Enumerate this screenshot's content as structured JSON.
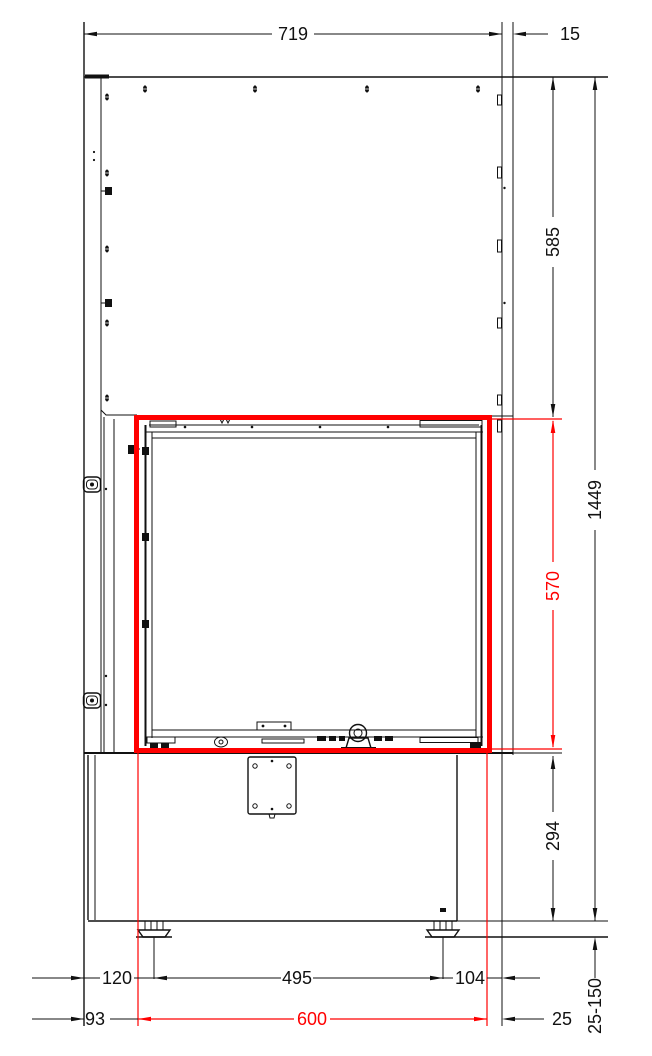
{
  "drawing": {
    "title": "fireplace-insert-front-elevation",
    "highlighted_feature": "glass-opening"
  },
  "dimensions": {
    "top_width": "719",
    "right_flange": "15",
    "upper_section_height": "585",
    "overall_height": "1449",
    "opening_height": "570",
    "plinth_height": "294",
    "leveling_feet_range": "25-150",
    "left_foot_offset": "120",
    "feet_spacing": "495",
    "right_foot_offset": "104",
    "opening_left_offset": "93",
    "opening_width": "600",
    "opening_right_offset": "25"
  },
  "colors": {
    "highlight_red": "#ff0000",
    "line_black": "#111111",
    "background": "#ffffff"
  }
}
